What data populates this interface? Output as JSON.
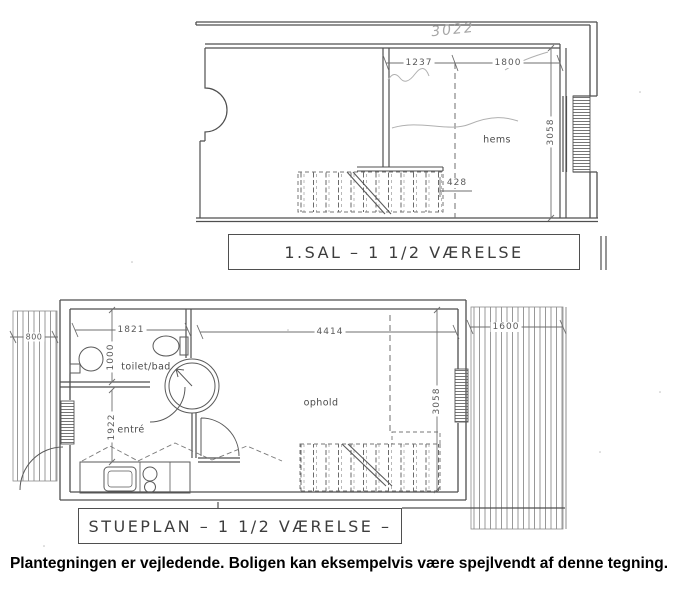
{
  "caption": "Plantegningen er vejledende. Boligen kan eksempelvis være spejlvendt af denne tegning.",
  "upper": {
    "title": "1.SAL  –  1 1/2 VÆRELSE",
    "handwritten_note": "3022",
    "rooms": {
      "hems": "hems"
    },
    "dims": {
      "width_left": "1237",
      "width_right": "1800",
      "depth": "3058",
      "stair_landing": "428"
    }
  },
  "lower": {
    "title": "STUEPLAN  –  1 1/2 VÆRELSE  –",
    "rooms": {
      "bath": "toilet/bad",
      "hall": "entré",
      "living": "ophold"
    },
    "dims": {
      "bath_width": "1821",
      "bath_depth": "1000",
      "hall_depth": "1922",
      "living_width": "4414",
      "living_depth": "3058",
      "deck_left": "800",
      "deck_right": "1600"
    }
  },
  "colors": {
    "wall_line": "#4f4f4f",
    "thin_line": "#6f6f6f",
    "pencil": "#a6a6a6",
    "label_text": "#4a4a4a",
    "caption_text": "#000000",
    "paper": "#ffffff"
  }
}
